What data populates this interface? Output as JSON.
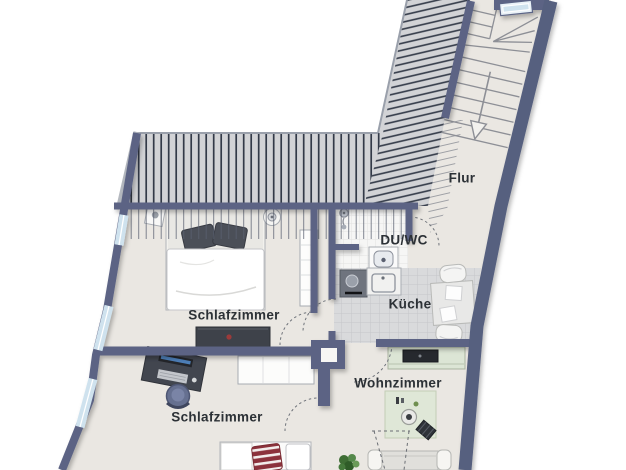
{
  "floorplan": {
    "type": "apartment-floor-plan",
    "rooms": [
      {
        "id": "flur",
        "label": "Flur",
        "furniture": [
          "staircase",
          "stair-down-arrow-icon"
        ]
      },
      {
        "id": "du-wc",
        "label": "DU/WC",
        "furniture": [
          "shower-icon",
          "toilet-icon"
        ]
      },
      {
        "id": "kueche",
        "label": "Küche",
        "furniture": [
          "kitchen-counter",
          "sink-icon",
          "stove-icon",
          "dining-table",
          "chair",
          "chair"
        ]
      },
      {
        "id": "schlafzimmer-1",
        "label": "Schlafzimmer",
        "furniture": [
          "double-bed",
          "nightstand",
          "side-table",
          "wardrobe",
          "dresser"
        ]
      },
      {
        "id": "schlafzimmer-2",
        "label": "Schlafzimmer",
        "furniture": [
          "desk",
          "office-chair",
          "wardrobe",
          "bed"
        ]
      },
      {
        "id": "wohnzimmer",
        "label": "Wohnzimmer",
        "furniture": [
          "tv-sideboard",
          "rug",
          "coffee-table",
          "ottoman",
          "sofa",
          "plant"
        ]
      }
    ],
    "stair": {
      "direction_arrow": "down"
    },
    "window_count": 4,
    "colors": {
      "wall": "#5b6384",
      "wall_outer": "#57607f",
      "floor": "#eae7e2",
      "roof_hatch_bg": "#d2d3d6",
      "hatch_line": "#333a48",
      "window_glass": "#cfe2ee",
      "kitchen_tile": "#d9dadc",
      "bath_tile": "#f6f6f5",
      "rug_green": "#dfe7d7",
      "accent_red": "#8c323c",
      "label_text": "#2c3136"
    }
  }
}
